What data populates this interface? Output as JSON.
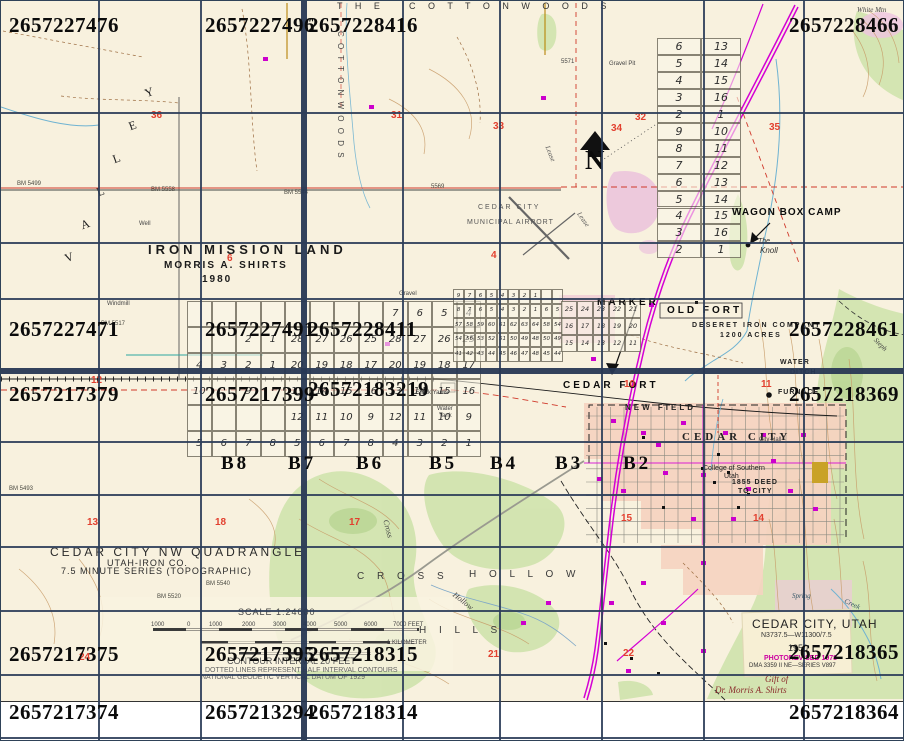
{
  "canvas": {
    "w": 904,
    "h": 741
  },
  "colors": {
    "paper": "#f8f1de",
    "grid_overlay": "#2d3e5a",
    "highway": "#d400d4",
    "water": "#6fb3d2",
    "contour": "#c79a66",
    "vegetation": "#cfe3ad",
    "urban": "#f5d3c0",
    "section_red": "#e2402f",
    "photorevised_magenta": "#cc00a0",
    "handwriting_red": "#8a2b2b"
  },
  "overlay": {
    "tile_ids": [
      {
        "t": "2657227476",
        "x": 8,
        "y": 14
      },
      {
        "t": "2657227496",
        "x": 204,
        "y": 14
      },
      {
        "t": "2657228416",
        "x": 307,
        "y": 14
      },
      {
        "t": "2657228466",
        "x": 898,
        "y": 14,
        "a": "r"
      },
      {
        "t": "2657227471",
        "x": 8,
        "y": 318
      },
      {
        "t": "2657227491",
        "x": 204,
        "y": 318
      },
      {
        "t": "2657228411",
        "x": 307,
        "y": 318
      },
      {
        "t": "2657228461",
        "x": 898,
        "y": 318,
        "a": "r"
      },
      {
        "t": "2657217379",
        "x": 8,
        "y": 383
      },
      {
        "t": "2657217399",
        "x": 204,
        "y": 383
      },
      {
        "t": "26572183219",
        "x": 307,
        "y": 378
      },
      {
        "t": "2657218369",
        "x": 898,
        "y": 383,
        "a": "r"
      },
      {
        "t": "2657217375",
        "x": 8,
        "y": 643
      },
      {
        "t": "2657217395",
        "x": 204,
        "y": 643
      },
      {
        "t": "2657218315",
        "x": 307,
        "y": 643
      },
      {
        "t": "2657218365",
        "x": 898,
        "y": 641,
        "a": "r"
      },
      {
        "t": "2657217374",
        "x": 8,
        "y": 701
      },
      {
        "t": "2657213294",
        "x": 204,
        "y": 701
      },
      {
        "t": "2657218314",
        "x": 307,
        "y": 701
      },
      {
        "t": "2657218364",
        "x": 898,
        "y": 701,
        "a": "r"
      }
    ],
    "b_markers": [
      {
        "t": "B8",
        "x": 220,
        "y": 453
      },
      {
        "t": "B7",
        "x": 287,
        "y": 453
      },
      {
        "t": "B6",
        "x": 355,
        "y": 453
      },
      {
        "t": "B5",
        "x": 428,
        "y": 453
      },
      {
        "t": "B4",
        "x": 489,
        "y": 453
      },
      {
        "t": "B3",
        "x": 554,
        "y": 453
      },
      {
        "t": "B2",
        "x": 622,
        "y": 453
      }
    ]
  },
  "map": {
    "labels": [
      {
        "t": "T H E",
        "x": 336,
        "y": 1,
        "fs": 9,
        "ls": 5,
        "c": "#333"
      },
      {
        "t": "C O T T O N W O O D S",
        "x": 408,
        "y": 1,
        "fs": 9,
        "ls": 5,
        "c": "#333"
      },
      {
        "t": "C O T T O N W O O D S",
        "x": 343,
        "y": 30,
        "fs": 8,
        "ls": 2,
        "c": "#444",
        "r": 90
      },
      {
        "t": "V",
        "x": 62,
        "y": 252,
        "fs": 12,
        "f": "serif",
        "r": -20
      },
      {
        "t": "A",
        "x": 78,
        "y": 219,
        "fs": 12,
        "f": "serif",
        "r": -20
      },
      {
        "t": "L",
        "x": 94,
        "y": 186,
        "fs": 12,
        "f": "serif",
        "r": -20
      },
      {
        "t": "L",
        "x": 110,
        "y": 153,
        "fs": 12,
        "f": "serif",
        "r": -20
      },
      {
        "t": "E",
        "x": 126,
        "y": 120,
        "fs": 12,
        "f": "serif",
        "r": -20
      },
      {
        "t": "Y",
        "x": 142,
        "y": 87,
        "fs": 12,
        "f": "serif",
        "r": -20
      },
      {
        "t": "IRON MISSION LAND",
        "x": 147,
        "y": 242,
        "fs": 13,
        "ls": 4,
        "b": 1,
        "c": "#1a1a1a"
      },
      {
        "t": "MORRIS A. SHIRTS",
        "x": 163,
        "y": 260,
        "fs": 10,
        "ls": 2,
        "b": 1,
        "c": "#1a1a1a"
      },
      {
        "t": "1980",
        "x": 201,
        "y": 274,
        "fs": 10,
        "ls": 2,
        "b": 1,
        "c": "#1a1a1a"
      },
      {
        "t": "CEDAR CITY",
        "x": 477,
        "y": 203,
        "fs": 7,
        "ls": 2,
        "c": "#555"
      },
      {
        "t": "MUNICIPAL AIRPORT",
        "x": 466,
        "y": 218,
        "fs": 7,
        "ls": 1,
        "c": "#555"
      },
      {
        "t": "N",
        "x": 584,
        "y": 146,
        "fs": 27,
        "b": 1,
        "f": "serif",
        "c": "#0b0b0b"
      },
      {
        "t": "WAGON BOX CAMP",
        "x": 731,
        "y": 207,
        "fs": 10,
        "ls": 1,
        "b": 1,
        "c": "#0b0b0b"
      },
      {
        "t": "The",
        "x": 757,
        "y": 237,
        "fs": 7,
        "i": 1,
        "c": "#333"
      },
      {
        "t": "Knoll",
        "x": 759,
        "y": 246,
        "fs": 8,
        "i": 1,
        "c": "#333"
      },
      {
        "t": "MARKER",
        "x": 596,
        "y": 297,
        "fs": 10,
        "ls": 3,
        "b": 1,
        "c": "#0b0b0b"
      },
      {
        "t": "OLD FORT",
        "x": 666,
        "y": 305,
        "fs": 10,
        "ls": 3,
        "b": 1,
        "c": "#0b0b0b"
      },
      {
        "t": "DESERET IRON COMPANY",
        "x": 691,
        "y": 321,
        "fs": 7,
        "ls": 2,
        "b": 1
      },
      {
        "t": "1200 ACRES",
        "x": 719,
        "y": 331,
        "fs": 7,
        "ls": 2,
        "b": 1
      },
      {
        "t": "WATER",
        "x": 779,
        "y": 358,
        "fs": 7,
        "ls": 1,
        "b": 1
      },
      {
        "t": "DITCH",
        "x": 789,
        "y": 368,
        "fs": 7,
        "ls": 1,
        "b": 1
      },
      {
        "t": "FURNACE",
        "x": 777,
        "y": 388,
        "fs": 7,
        "ls": 1,
        "b": 1
      },
      {
        "t": "CEDAR FORT",
        "x": 562,
        "y": 380,
        "fs": 10,
        "ls": 3,
        "b": 1,
        "c": "#0b0b0b"
      },
      {
        "t": "NEW FIELD",
        "x": 624,
        "y": 403,
        "fs": 8,
        "ls": 3,
        "b": 1
      },
      {
        "t": "CEDAR CITY",
        "x": 681,
        "y": 431,
        "fs": 11,
        "ls": 4,
        "b": 1,
        "f": "serif"
      },
      {
        "t": "City Hall",
        "x": 758,
        "y": 436,
        "fs": 6,
        "c": "#444"
      },
      {
        "t": "College of Southern",
        "x": 702,
        "y": 464,
        "fs": 7
      },
      {
        "t": "Utah",
        "x": 723,
        "y": 472,
        "fs": 7
      },
      {
        "t": "1855 DEED",
        "x": 731,
        "y": 478,
        "fs": 7,
        "ls": 1,
        "b": 1
      },
      {
        "t": "TO CITY",
        "x": 737,
        "y": 487,
        "fs": 7,
        "ls": 1,
        "b": 1
      },
      {
        "t": "CEDAR CITY NW QUADRANGLE",
        "x": 49,
        "y": 545,
        "fs": 12,
        "ls": 3,
        "c": "#2a2a2a"
      },
      {
        "t": "UTAH-IRON CO.",
        "x": 106,
        "y": 558,
        "fs": 9,
        "ls": 1,
        "c": "#2a2a2a"
      },
      {
        "t": "7.5 MINUTE SERIES (TOPOGRAPHIC)",
        "x": 60,
        "y": 566,
        "fs": 9,
        "ls": 1,
        "c": "#2a2a2a"
      },
      {
        "t": "SCALE 1:24000",
        "x": 237,
        "y": 607,
        "fs": 9,
        "ls": 1,
        "c": "#444"
      },
      {
        "t": "1000",
        "x": 150,
        "y": 621,
        "fs": 6,
        "c": "#444"
      },
      {
        "t": "0",
        "x": 186,
        "y": 621,
        "fs": 6,
        "c": "#444"
      },
      {
        "t": "1000",
        "x": 208,
        "y": 621,
        "fs": 6,
        "c": "#444"
      },
      {
        "t": "2000",
        "x": 241,
        "y": 621,
        "fs": 6,
        "c": "#444"
      },
      {
        "t": "3000",
        "x": 272,
        "y": 621,
        "fs": 6,
        "c": "#444"
      },
      {
        "t": "4000",
        "x": 302,
        "y": 621,
        "fs": 6,
        "c": "#444"
      },
      {
        "t": "5000",
        "x": 333,
        "y": 621,
        "fs": 6,
        "c": "#444"
      },
      {
        "t": "6000",
        "x": 363,
        "y": 621,
        "fs": 6,
        "c": "#444"
      },
      {
        "t": "7000 FEET",
        "x": 392,
        "y": 621,
        "fs": 6,
        "c": "#444"
      },
      {
        "t": "1 KILOMETER",
        "x": 386,
        "y": 639,
        "fs": 6,
        "c": "#444"
      },
      {
        "t": "CONTOUR INTERVAL 20 FEET",
        "x": 226,
        "y": 656,
        "fs": 9,
        "c": "#555"
      },
      {
        "t": "DOTTED LINES REPRESENT HALF INTERVAL CONTOURS",
        "x": 204,
        "y": 666,
        "fs": 7,
        "c": "#666"
      },
      {
        "t": "NATIONAL GEODETIC VERTICAL DATUM OF 1929",
        "x": 200,
        "y": 673,
        "fs": 7,
        "c": "#666"
      },
      {
        "t": "CEDAR CITY, UTAH",
        "x": 751,
        "y": 617,
        "fs": 12,
        "ls": 1,
        "c": "#222"
      },
      {
        "t": "N3737.5—W11300/7.5",
        "x": 760,
        "y": 631,
        "fs": 7,
        "c": "#333"
      },
      {
        "t": "1950",
        "x": 787,
        "y": 643,
        "fs": 9,
        "c": "#333"
      },
      {
        "t": "PHOTOREVISED 1978",
        "x": 763,
        "y": 654,
        "fs": 7,
        "b": 1,
        "c": "#cc00a0"
      },
      {
        "t": "DMA 3359 II NE—SERIES V897",
        "x": 748,
        "y": 662,
        "fs": 6,
        "c": "#333"
      },
      {
        "t": "Gift of",
        "x": 764,
        "y": 674,
        "fs": 9,
        "i": 1,
        "f": "serif",
        "c": "#8a2b2b"
      },
      {
        "t": "Dr. Morris A. Shirts",
        "x": 714,
        "y": 685,
        "fs": 9,
        "i": 1,
        "f": "serif",
        "c": "#8a2b2b"
      },
      {
        "t": "C R O S S",
        "x": 356,
        "y": 571,
        "fs": 10,
        "ls": 5,
        "c": "#3a3a3a"
      },
      {
        "t": "H O L L O W",
        "x": 468,
        "y": 569,
        "fs": 10,
        "ls": 5,
        "c": "#3a3a3a"
      },
      {
        "t": "H I L L S",
        "x": 418,
        "y": 625,
        "fs": 10,
        "ls": 5,
        "c": "#3a3a3a"
      },
      {
        "t": "Hollow",
        "x": 455,
        "y": 590,
        "fs": 8,
        "i": 1,
        "f": "serif",
        "r": 38,
        "c": "#444"
      },
      {
        "t": "Cross",
        "x": 388,
        "y": 518,
        "fs": 8,
        "i": 1,
        "f": "serif",
        "r": 75,
        "c": "#444"
      },
      {
        "t": "Spring",
        "x": 791,
        "y": 592,
        "fs": 7,
        "i": 1,
        "f": "serif",
        "c": "#335566"
      },
      {
        "t": "Creek",
        "x": 845,
        "y": 597,
        "fs": 7,
        "i": 1,
        "f": "serif",
        "r": 25,
        "c": "#335566"
      },
      {
        "t": "Stock Yards",
        "x": 415,
        "y": 389,
        "fs": 6,
        "c": "#444"
      },
      {
        "t": "Water",
        "x": 436,
        "y": 405,
        "fs": 6,
        "c": "#444"
      },
      {
        "t": "Tank",
        "x": 438,
        "y": 412,
        "fs": 6,
        "c": "#444"
      },
      {
        "t": "Windmill",
        "x": 106,
        "y": 300,
        "fs": 6,
        "c": "#444"
      },
      {
        "t": "Well",
        "x": 138,
        "y": 220,
        "fs": 6,
        "c": "#444"
      },
      {
        "t": "White Mtn",
        "x": 856,
        "y": 6,
        "fs": 7,
        "i": 1,
        "f": "serif",
        "c": "#444"
      },
      {
        "t": "Gravel Pit",
        "x": 608,
        "y": 60,
        "fs": 6,
        "c": "#444"
      },
      {
        "t": "Gravel",
        "x": 398,
        "y": 290,
        "fs": 6,
        "c": "#444"
      },
      {
        "t": "Lease",
        "x": 549,
        "y": 144,
        "fs": 7,
        "i": 1,
        "f": "serif",
        "r": 68,
        "c": "#555"
      },
      {
        "t": "Lease",
        "x": 580,
        "y": 210,
        "fs": 7,
        "i": 1,
        "f": "serif",
        "r": 55,
        "c": "#555"
      },
      {
        "t": "Steph",
        "x": 876,
        "y": 336,
        "fs": 7,
        "i": 1,
        "f": "serif",
        "r": 45,
        "c": "#444"
      },
      {
        "t": "5571",
        "x": 560,
        "y": 58,
        "fs": 6,
        "c": "#444"
      }
    ],
    "red_section_numbers": [
      {
        "t": "36",
        "x": 150,
        "y": 110
      },
      {
        "t": "31",
        "x": 390,
        "y": 110
      },
      {
        "t": "32",
        "x": 634,
        "y": 112
      },
      {
        "t": "33",
        "x": 492,
        "y": 121
      },
      {
        "t": "34",
        "x": 610,
        "y": 123
      },
      {
        "t": "35",
        "x": 768,
        "y": 122
      },
      {
        "t": "6",
        "x": 226,
        "y": 253
      },
      {
        "t": "4",
        "x": 490,
        "y": 250
      },
      {
        "t": "12",
        "x": 90,
        "y": 375
      },
      {
        "t": "10",
        "x": 623,
        "y": 379
      },
      {
        "t": "11",
        "x": 760,
        "y": 379
      },
      {
        "t": "13",
        "x": 86,
        "y": 517
      },
      {
        "t": "18",
        "x": 214,
        "y": 517
      },
      {
        "t": "17",
        "x": 348,
        "y": 517
      },
      {
        "t": "15",
        "x": 620,
        "y": 513
      },
      {
        "t": "14",
        "x": 752,
        "y": 513
      },
      {
        "t": "24",
        "x": 78,
        "y": 652
      },
      {
        "t": "21",
        "x": 487,
        "y": 649
      },
      {
        "t": "22",
        "x": 622,
        "y": 648
      }
    ],
    "benchmarks": [
      {
        "t": "BM 5499",
        "x": 16,
        "y": 180
      },
      {
        "t": "BM 5517",
        "x": 100,
        "y": 320
      },
      {
        "t": "BM 5558",
        "x": 150,
        "y": 186
      },
      {
        "t": "BM 5544",
        "x": 283,
        "y": 189
      },
      {
        "t": "5569",
        "x": 430,
        "y": 183
      },
      {
        "t": "BM 5520",
        "x": 156,
        "y": 593
      },
      {
        "t": "BM 5540",
        "x": 205,
        "y": 580
      },
      {
        "t": "BM 5493",
        "x": 8,
        "y": 485
      }
    ],
    "plats": [
      {
        "name": "plat-survey-west",
        "x": 186,
        "y": 300,
        "cw": 24.5,
        "rh": 26,
        "fs": 10,
        "rows": [
          [
            "",
            "",
            "",
            "",
            "",
            "",
            "",
            "",
            "7",
            "6",
            "5",
            "4"
          ],
          [
            "",
            "",
            "2",
            "1",
            "28",
            "27",
            "26",
            "25",
            "28",
            "27",
            "26",
            "25"
          ],
          [
            "4",
            "3",
            "2",
            "1",
            "20",
            "19",
            "18",
            "17",
            "20",
            "19",
            "18",
            "17"
          ],
          [
            "10",
            "",
            "9",
            "",
            "13",
            "14",
            "15",
            "16",
            "13",
            "14",
            "15",
            "16"
          ],
          [
            "",
            "",
            "",
            "",
            "12",
            "11",
            "10",
            "9",
            "12",
            "11",
            "10",
            "9"
          ],
          [
            "5",
            "6",
            "7",
            "8",
            "5",
            "6",
            "7",
            "8",
            "4",
            "3",
            "2",
            "1"
          ]
        ]
      },
      {
        "name": "plat-marker-blocks",
        "x": 452,
        "y": 288,
        "cw": 11,
        "rh": 14.5,
        "fs": 5.5,
        "rows": [
          [
            "9",
            "7",
            "6",
            "5",
            "4",
            "3",
            "2",
            "1",
            "",
            ""
          ],
          [
            "8",
            "7",
            "6",
            "5",
            "4",
            "3",
            "2",
            "1",
            "6",
            "5"
          ],
          [
            "57",
            "58",
            "59",
            "60",
            "61",
            "62",
            "63",
            "64",
            "58",
            "54"
          ],
          [
            "54",
            "56",
            "53",
            "52",
            "51",
            "50",
            "49",
            "48",
            "50",
            "49"
          ],
          [
            "41",
            "42",
            "43",
            "44",
            "45",
            "46",
            "47",
            "48",
            "45",
            "44"
          ]
        ]
      },
      {
        "name": "plat-old-fort",
        "x": 560,
        "y": 300,
        "cw": 16,
        "rh": 17,
        "fs": 6.5,
        "rows": [
          [
            "25",
            "24",
            "23",
            "22",
            "21"
          ],
          [
            "16",
            "17",
            "18",
            "19",
            "20"
          ],
          [
            "15",
            "14",
            "13",
            "12",
            "11"
          ]
        ]
      },
      {
        "name": "plat-sections-northeast",
        "x": 656,
        "y": 37,
        "cws": [
          44,
          40
        ],
        "rh": 16.95,
        "fs": 11,
        "rows": [
          [
            "6",
            "13"
          ],
          [
            "5",
            "14"
          ],
          [
            "4",
            "15"
          ],
          [
            "3",
            "16"
          ],
          [
            "2",
            "1"
          ],
          [
            "9",
            "10"
          ],
          [
            "8",
            "11"
          ],
          [
            "7",
            "12"
          ],
          [
            "6",
            "13"
          ],
          [
            "5",
            "14"
          ],
          [
            "4",
            "15"
          ],
          [
            "3",
            "16"
          ],
          [
            "2",
            "1"
          ]
        ]
      }
    ]
  }
}
